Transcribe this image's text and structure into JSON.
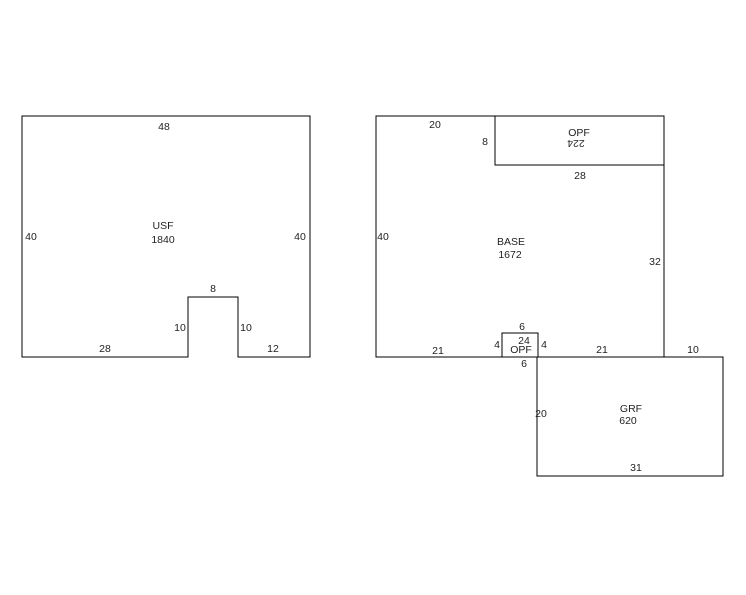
{
  "sketch": {
    "background": "#ffffff",
    "line_color": "#000000",
    "text_color": "#1f1f1f"
  },
  "figures": {
    "usf": {
      "label": "USF",
      "area": "1840",
      "dims": {
        "top": "48",
        "left": "40",
        "right": "40",
        "notch_top": "8",
        "notch_left": "10",
        "notch_right": "10",
        "bottom_left": "28",
        "bottom_right": "12"
      }
    },
    "base": {
      "label": "BASE",
      "area": "1672",
      "dims": {
        "top": "20",
        "left": "40",
        "right": "32",
        "bottom_left": "21",
        "bottom_right": "21",
        "bottom_offset": "10"
      }
    },
    "opf_top": {
      "label": "OPF",
      "area": "224",
      "dims": {
        "left": "8",
        "bottom": "28"
      }
    },
    "opf_small": {
      "label": "OPF",
      "area": "24",
      "dims": {
        "top": "6",
        "left": "4",
        "right": "4",
        "bottom": "6"
      }
    },
    "grf": {
      "label": "GRF",
      "area": "620",
      "dims": {
        "left": "20",
        "bottom": "31"
      }
    }
  }
}
